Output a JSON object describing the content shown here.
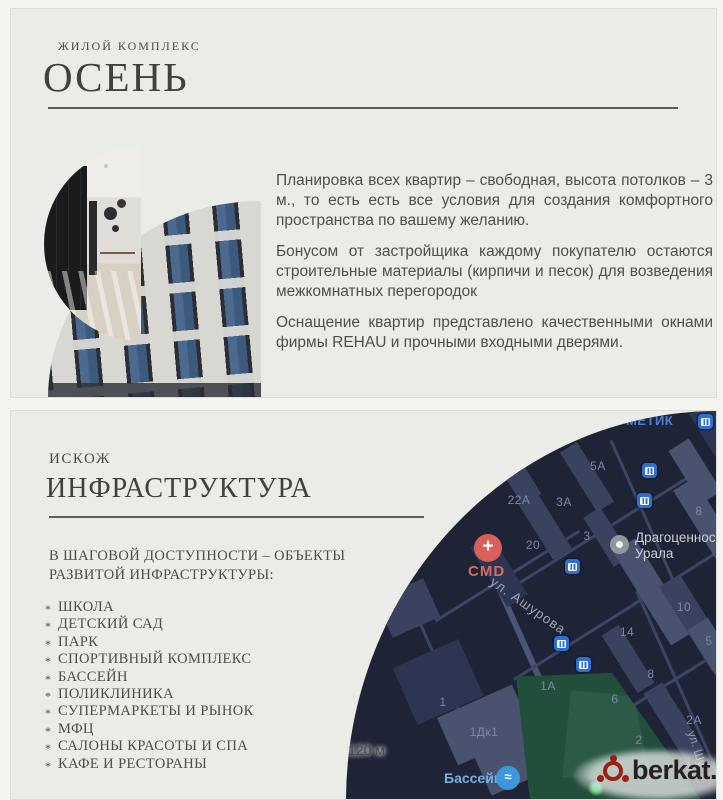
{
  "slide1": {
    "eyebrow": "ЖИЛОЙ КОМПЛЕКС",
    "title": "ОСЕНЬ",
    "paragraphs": {
      "p1": "Планировка всех квартир – свободная, высота потолков – 3 м., то есть есть все условия для создания комфортного пространства по вашему желанию.",
      "p2": "Бонусом от застройщика каждому покупателю остаются строительные материалы (кирпичи и песок) для возведения межкомнатных перегородок",
      "p3": "Оснащение квартир представлено качественными окнами фирмы REHAU и прочными входными дверями."
    }
  },
  "slide2": {
    "eyebrow": "ИСКОЖ",
    "title": "ИНФРАСТРУКТУРА",
    "intro_line1": "В ШАГОВОЙ ДОСТУПНОСТИ – ОБЪЕКТЫ",
    "intro_line2": "РАЗВИТОЙ ИНФРАСТРУКТУРЫ:",
    "items": [
      "ШКОЛА",
      "ДЕТСКИЙ САД",
      "ПАРК",
      "СПОРТИВНЫЙ КОМПЛЕКС",
      "БАССЕЙН",
      "ПОЛИКЛИНИКА",
      "СУПЕРМАРКЕТЫ И РЫНОК",
      "МФЦ",
      "САЛОНЫ КРАСОТЫ И СПА",
      "КАФЕ И РЕСТОРАНЫ"
    ]
  },
  "map": {
    "scale_label": "120 м",
    "partial_top_label": "МЕТИК",
    "street_ashurova": "ул. Ашурова",
    "street_partial": "ул. Шу",
    "poi_cmd_label": "CMD",
    "poi_cmd_plus": "+",
    "poi_jewelry_line1": "Драгоценности",
    "poi_jewelry_line2": "Урала",
    "poi_pool_label": "Бассейн",
    "poi_pool_glyph": "≈",
    "numbers": [
      "5А",
      "22А",
      "3А",
      "20",
      "3",
      "8",
      "10",
      "14",
      "5",
      "8",
      "6",
      "2А",
      "2",
      "1",
      "1А",
      "1",
      "1Дк1"
    ],
    "colors": {
      "bg": "#1e2336",
      "building": "#3a4260",
      "road": "#3c4565",
      "park": "#224e3c",
      "poi_red": "#d85f5c",
      "icon_blue": "#2e6fd4"
    }
  },
  "watermark": {
    "text": "berkat."
  },
  "theme": {
    "slide_bg": "#e9ece7",
    "heading": "#3d423c",
    "body_text": "#4c514b",
    "rule": "#5a5f58"
  }
}
